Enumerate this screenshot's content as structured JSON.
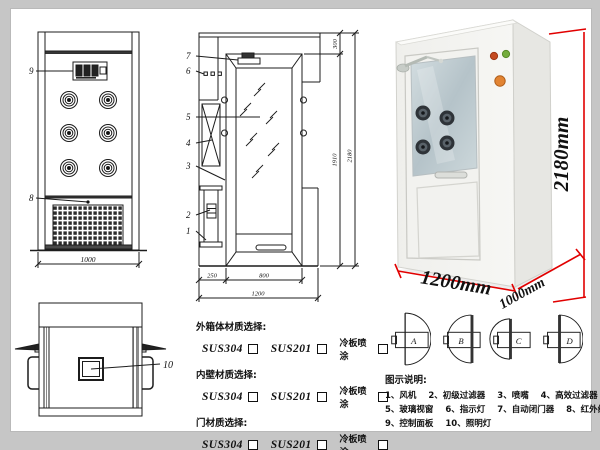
{
  "front_view": {
    "callout_control_panel": "9",
    "callout_grille": "8",
    "dim_width": "1000"
  },
  "section_view": {
    "callouts": [
      "7",
      "6",
      "5",
      "4",
      "3",
      "2",
      "1"
    ],
    "dim_top": "300",
    "dim_inner_height": "1910",
    "dim_total_height": "2180",
    "dim_left_depth": "250",
    "dim_door_width": "800",
    "dim_total_width": "1200"
  },
  "top_view": {
    "callout_lamp": "10"
  },
  "photo": {
    "dim_height": "2180mm",
    "dim_width": "1200mm",
    "dim_depth": "1000mm",
    "accent_color": "#e10000"
  },
  "materials": {
    "groups": [
      {
        "title": "外箱体材质选择:",
        "options": [
          "SUS304",
          "SUS201",
          "冷板喷涂"
        ]
      },
      {
        "title": "内壁材质选择:",
        "options": [
          "SUS304",
          "SUS201",
          "冷板喷涂"
        ]
      },
      {
        "title": "门材质选择:",
        "options": [
          "SUS304",
          "SUS201",
          "冷板喷涂"
        ]
      }
    ]
  },
  "door_options": {
    "labels": [
      "A",
      "B",
      "C",
      "D"
    ]
  },
  "legend": {
    "title": "图示说明:",
    "rows": [
      [
        "1、风机",
        "2、初级过滤器",
        "3、喷嘴",
        "4、高效过滤器"
      ],
      [
        "5、玻璃视窗",
        "6、指示灯",
        "7、自动闭门器",
        "8、红外线感应器"
      ],
      [
        "9、控制面板",
        "10、照明灯"
      ]
    ]
  }
}
